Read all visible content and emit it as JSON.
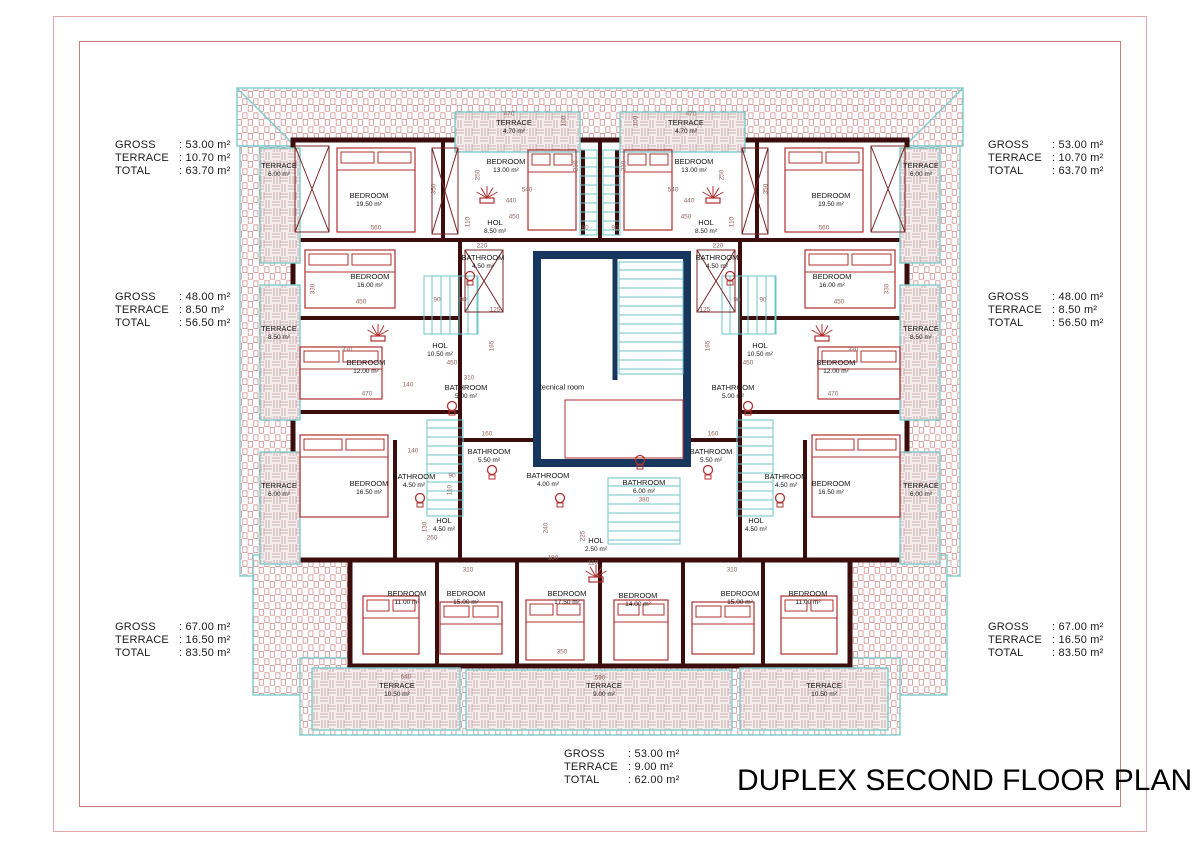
{
  "title": "DUPLEX SECOND FLOOR PLAN",
  "annotations": {
    "left_top": {
      "rows": [
        {
          "label": "GROSS",
          "value": ": 53.00 m²"
        },
        {
          "label": "TERRACE",
          "value": ": 10.70 m²"
        },
        {
          "label": "TOTAL",
          "value": ": 63.70 m²"
        }
      ]
    },
    "left_middle": {
      "rows": [
        {
          "label": "GROSS",
          "value": ": 48.00 m²"
        },
        {
          "label": "TERRACE",
          "value": ": 8.50 m²"
        },
        {
          "label": "TOTAL",
          "value": ": 56.50 m²"
        }
      ]
    },
    "left_bottom": {
      "rows": [
        {
          "label": "GROSS",
          "value": ": 67.00 m²"
        },
        {
          "label": "TERRACE",
          "value": ": 16.50 m²"
        },
        {
          "label": "TOTAL",
          "value": ": 83.50 m²"
        }
      ]
    },
    "right_top": {
      "rows": [
        {
          "label": "GROSS",
          "value": ": 53.00 m²"
        },
        {
          "label": "TERRACE",
          "value": ": 10.70 m²"
        },
        {
          "label": "TOTAL",
          "value": ": 63.70 m²"
        }
      ]
    },
    "right_middle": {
      "rows": [
        {
          "label": "GROSS",
          "value": ": 48.00 m²"
        },
        {
          "label": "TERRACE",
          "value": ": 8.50 m²"
        },
        {
          "label": "TOTAL",
          "value": ": 56.50 m²"
        }
      ]
    },
    "right_bottom": {
      "rows": [
        {
          "label": "GROSS",
          "value": ": 67.00 m²"
        },
        {
          "label": "TERRACE",
          "value": ": 16.50 m²"
        },
        {
          "label": "TOTAL",
          "value": ": 83.50 m²"
        }
      ]
    },
    "bottom_center": {
      "rows": [
        {
          "label": "GROSS",
          "value": ": 53.00 m²"
        },
        {
          "label": "TERRACE",
          "value": ": 9.00 m²"
        },
        {
          "label": "TOTAL",
          "value": ": 62.00 m²"
        }
      ]
    }
  },
  "plan": {
    "colors": {
      "wall": "#3b0d0d",
      "core": "#17375f",
      "stair": "#6fc6ca",
      "roof_edge": "#7ecccc",
      "furniture": "#b03030",
      "dimension": "#95645f"
    },
    "rooms": [
      {
        "name": "TERRACE",
        "area": "6.00 m²",
        "x": 279,
        "y": 170
      },
      {
        "name": "BEDROOM",
        "area": "19.50 m²",
        "x": 369,
        "y": 200
      },
      {
        "name": "TERRACE",
        "area": "4.70 m²",
        "x": 514,
        "y": 127
      },
      {
        "name": "BEDROOM",
        "area": "13.00 m²",
        "x": 506,
        "y": 166
      },
      {
        "name": "HOL",
        "area": "8.50 m²",
        "x": 495,
        "y": 227
      },
      {
        "name": "BATHROOM",
        "area": "4.50 m²",
        "x": 483,
        "y": 262
      },
      {
        "name": "BEDROOM",
        "area": "16.00 m²",
        "x": 370,
        "y": 281
      },
      {
        "name": "TERRACE",
        "area": "8.50 m²",
        "x": 279,
        "y": 333
      },
      {
        "name": "HOL",
        "area": "10.50 m²",
        "x": 440,
        "y": 350
      },
      {
        "name": "BEDROOM",
        "area": "12.00 m²",
        "x": 366,
        "y": 367
      },
      {
        "name": "BATHROOM",
        "area": "5.00 m²",
        "x": 466,
        "y": 392
      },
      {
        "name": "BATHROOM",
        "area": "4.50 m²",
        "x": 414,
        "y": 481
      },
      {
        "name": "BEDROOM",
        "area": "16.50 m²",
        "x": 369,
        "y": 488
      },
      {
        "name": "BATHROOM",
        "area": "5.50 m²",
        "x": 489,
        "y": 456
      },
      {
        "name": "TERRACE",
        "area": "6.00 m²",
        "x": 279,
        "y": 490
      },
      {
        "name": "HOL",
        "area": "4.50 m²",
        "x": 444,
        "y": 525
      },
      {
        "name": "BATHROOM",
        "area": "4.00 m²",
        "x": 548,
        "y": 480
      },
      {
        "name": "BATHROOM",
        "area": "6.00 m²",
        "x": 644,
        "y": 487
      },
      {
        "name": "HOL",
        "area": "2.50 m²",
        "x": 596,
        "y": 545
      },
      {
        "name": "tecnical room",
        "area": "",
        "x": 562,
        "y": 388
      },
      {
        "name": "BEDROOM",
        "area": "11.00 m²",
        "x": 407,
        "y": 598
      },
      {
        "name": "BEDROOM",
        "area": "15.00 m²",
        "x": 466,
        "y": 598
      },
      {
        "name": "BEDROOM",
        "area": "17.50 m²",
        "x": 567,
        "y": 598
      },
      {
        "name": "BEDROOM",
        "area": "14.00 m²",
        "x": 638,
        "y": 600
      },
      {
        "name": "BEDROOM",
        "area": "15.00 m²",
        "x": 740,
        "y": 598
      },
      {
        "name": "BEDROOM",
        "area": "11.00 m²",
        "x": 808,
        "y": 598
      },
      {
        "name": "TERRACE",
        "area": "10.50 m²",
        "x": 397,
        "y": 690
      },
      {
        "name": "TERRACE",
        "area": "9.00 m²",
        "x": 604,
        "y": 690
      },
      {
        "name": "TERRACE",
        "area": "10.50 m²",
        "x": 824,
        "y": 690
      },
      {
        "name": "TERRACE",
        "area": "6.00 m²",
        "x": 921,
        "y": 170
      },
      {
        "name": "BEDROOM",
        "area": "19.50 m²",
        "x": 831,
        "y": 200
      },
      {
        "name": "TERRACE",
        "area": "4.70 m²",
        "x": 686,
        "y": 127
      },
      {
        "name": "BEDROOM",
        "area": "13.00 m²",
        "x": 694,
        "y": 166
      },
      {
        "name": "HOL",
        "area": "8.50 m²",
        "x": 706,
        "y": 227
      },
      {
        "name": "BATHROOM",
        "area": "4.50 m²",
        "x": 717,
        "y": 262
      },
      {
        "name": "BEDROOM",
        "area": "16.00 m²",
        "x": 832,
        "y": 281
      },
      {
        "name": "TERRACE",
        "area": "8.50 m²",
        "x": 921,
        "y": 333
      },
      {
        "name": "HOL",
        "area": "10.50 m²",
        "x": 760,
        "y": 350
      },
      {
        "name": "BEDROOM",
        "area": "12.00 m²",
        "x": 836,
        "y": 367
      },
      {
        "name": "BATHROOM",
        "area": "5.00 m²",
        "x": 733,
        "y": 392
      },
      {
        "name": "BATHROOM",
        "area": "4.50 m²",
        "x": 786,
        "y": 481
      },
      {
        "name": "BEDROOM",
        "area": "16.50 m²",
        "x": 831,
        "y": 488
      },
      {
        "name": "BATHROOM",
        "area": "5.50 m²",
        "x": 711,
        "y": 456
      },
      {
        "name": "TERRACE",
        "area": "6.00 m²",
        "x": 921,
        "y": 490
      },
      {
        "name": "HOL",
        "area": "4.50 m²",
        "x": 756,
        "y": 525
      }
    ],
    "dimensions": [
      {
        "text": "470",
        "x": 509,
        "y": 114,
        "o": "h"
      },
      {
        "text": "470",
        "x": 691,
        "y": 114,
        "o": "h"
      },
      {
        "text": "100",
        "x": 564,
        "y": 121,
        "o": "v"
      },
      {
        "text": "100",
        "x": 636,
        "y": 121,
        "o": "v"
      },
      {
        "text": "210",
        "x": 576,
        "y": 166,
        "o": "v"
      },
      {
        "text": "210",
        "x": 624,
        "y": 166,
        "o": "v"
      },
      {
        "text": "250",
        "x": 478,
        "y": 175,
        "o": "v"
      },
      {
        "text": "250",
        "x": 722,
        "y": 175,
        "o": "v"
      },
      {
        "text": "350",
        "x": 434,
        "y": 189,
        "o": "v"
      },
      {
        "text": "350",
        "x": 766,
        "y": 189,
        "o": "v"
      },
      {
        "text": "560",
        "x": 376,
        "y": 228,
        "o": "h"
      },
      {
        "text": "560",
        "x": 824,
        "y": 228,
        "o": "h"
      },
      {
        "text": "110",
        "x": 468,
        "y": 222,
        "o": "v"
      },
      {
        "text": "110",
        "x": 732,
        "y": 222,
        "o": "v"
      },
      {
        "text": "540",
        "x": 527,
        "y": 190,
        "o": "h"
      },
      {
        "text": "540",
        "x": 673,
        "y": 190,
        "o": "h"
      },
      {
        "text": "440",
        "x": 511,
        "y": 201,
        "o": "h"
      },
      {
        "text": "440",
        "x": 689,
        "y": 201,
        "o": "h"
      },
      {
        "text": "450",
        "x": 514,
        "y": 217,
        "o": "h"
      },
      {
        "text": "450",
        "x": 686,
        "y": 217,
        "o": "h"
      },
      {
        "text": "220",
        "x": 482,
        "y": 246,
        "o": "h"
      },
      {
        "text": "220",
        "x": 718,
        "y": 246,
        "o": "h"
      },
      {
        "text": "90",
        "x": 585,
        "y": 228,
        "o": "h"
      },
      {
        "text": "90",
        "x": 615,
        "y": 228,
        "o": "h"
      },
      {
        "text": "330",
        "x": 313,
        "y": 289,
        "o": "v"
      },
      {
        "text": "330",
        "x": 887,
        "y": 289,
        "o": "v"
      },
      {
        "text": "450",
        "x": 361,
        "y": 302,
        "o": "h"
      },
      {
        "text": "450",
        "x": 839,
        "y": 302,
        "o": "h"
      },
      {
        "text": "90",
        "x": 437,
        "y": 300,
        "o": "h"
      },
      {
        "text": "90",
        "x": 463,
        "y": 300,
        "o": "h"
      },
      {
        "text": "90",
        "x": 737,
        "y": 300,
        "o": "h"
      },
      {
        "text": "90",
        "x": 763,
        "y": 300,
        "o": "h"
      },
      {
        "text": "125",
        "x": 495,
        "y": 310,
        "o": "h"
      },
      {
        "text": "125",
        "x": 705,
        "y": 310,
        "o": "h"
      },
      {
        "text": "330",
        "x": 347,
        "y": 350,
        "o": "h"
      },
      {
        "text": "330",
        "x": 853,
        "y": 350,
        "o": "h"
      },
      {
        "text": "450",
        "x": 452,
        "y": 363,
        "o": "h"
      },
      {
        "text": "450",
        "x": 748,
        "y": 363,
        "o": "h"
      },
      {
        "text": "165",
        "x": 492,
        "y": 346,
        "o": "v"
      },
      {
        "text": "165",
        "x": 708,
        "y": 346,
        "o": "v"
      },
      {
        "text": "140",
        "x": 408,
        "y": 385,
        "o": "h"
      },
      {
        "text": "470",
        "x": 367,
        "y": 394,
        "o": "h"
      },
      {
        "text": "470",
        "x": 833,
        "y": 394,
        "o": "h"
      },
      {
        "text": "310",
        "x": 469,
        "y": 378,
        "o": "h"
      },
      {
        "text": "160",
        "x": 487,
        "y": 434,
        "o": "h"
      },
      {
        "text": "160",
        "x": 713,
        "y": 434,
        "o": "h"
      },
      {
        "text": "140",
        "x": 413,
        "y": 451,
        "o": "h"
      },
      {
        "text": "90",
        "x": 452,
        "y": 476,
        "o": "h"
      },
      {
        "text": "110",
        "x": 450,
        "y": 490,
        "o": "v"
      },
      {
        "text": "130",
        "x": 425,
        "y": 527,
        "o": "v"
      },
      {
        "text": "260",
        "x": 432,
        "y": 538,
        "o": "h"
      },
      {
        "text": "240",
        "x": 546,
        "y": 528,
        "o": "v"
      },
      {
        "text": "180",
        "x": 553,
        "y": 558,
        "o": "h"
      },
      {
        "text": "225",
        "x": 583,
        "y": 536,
        "o": "v"
      },
      {
        "text": "380",
        "x": 644,
        "y": 500,
        "o": "h"
      },
      {
        "text": "110",
        "x": 593,
        "y": 563,
        "o": "h"
      },
      {
        "text": "310",
        "x": 468,
        "y": 570,
        "o": "h"
      },
      {
        "text": "310",
        "x": 732,
        "y": 570,
        "o": "h"
      },
      {
        "text": "350",
        "x": 562,
        "y": 652,
        "o": "h"
      },
      {
        "text": "640",
        "x": 406,
        "y": 677,
        "o": "h"
      },
      {
        "text": "590",
        "x": 600,
        "y": 678,
        "o": "h"
      }
    ]
  }
}
